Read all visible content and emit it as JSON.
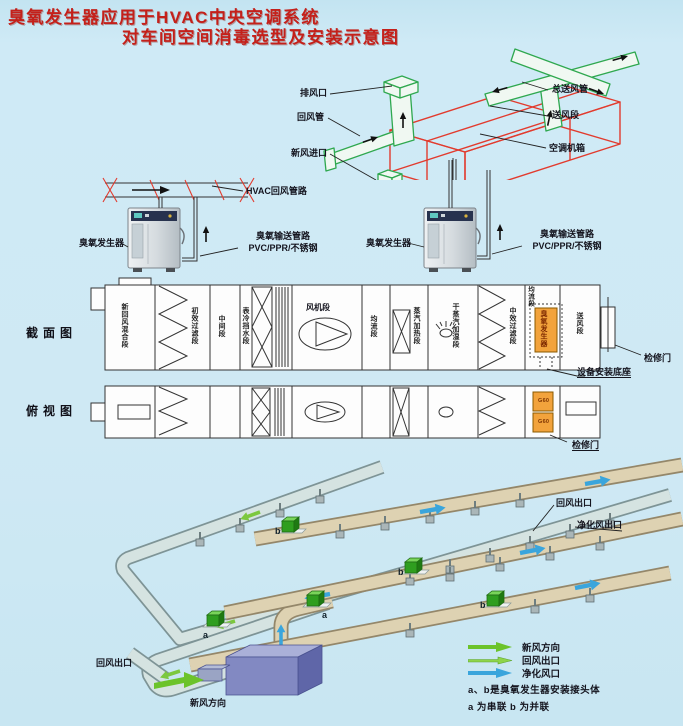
{
  "title": {
    "line1": "臭氧发生器应用于HVAC中央空调系统",
    "line2": "对车间空间消毒选型及安装示意图"
  },
  "top_diagram": {
    "exhaust_outlet": "排风口",
    "return_duct": "回风管",
    "fresh_air_inlet": "新风进口",
    "main_supply_duct": "总送风管",
    "supply_section": "送风段",
    "ahu_cabinet": "空调机箱"
  },
  "ozone_units": {
    "hvac_return_line": "HVAC回风管路",
    "left": {
      "name": "臭氧发生器",
      "pipe_line1": "臭氧输送管路",
      "pipe_line2": "PVC/PPR/不锈钢"
    },
    "right": {
      "name": "臭氧发生器",
      "pipe_line1": "臭氧输送管路",
      "pipe_line2": "PVC/PPR/不锈钢"
    }
  },
  "section_view": {
    "title": "截面图",
    "sections": [
      "新回风混合段",
      "初效过滤段",
      "中间段",
      "表冷挡水段",
      "风机段",
      "均流段",
      "蒸汽加热段",
      "干蒸汽加湿段",
      "中效过滤段",
      "均流段",
      "送风段"
    ],
    "ozone_box_label": "臭氧发生器",
    "access_door": "检修门",
    "mounting_base": "设备安装底座"
  },
  "plan_view": {
    "title": "俯视图",
    "unit_tag": "G60",
    "access_door": "检修门"
  },
  "network": {
    "return_outlet_left": "回风出口",
    "return_outlet_right": "回风出口",
    "purified_outlet": "净化风出口",
    "fresh_air_direction": "新风方向",
    "marker_a": "a",
    "marker_b": "b"
  },
  "legend": {
    "fresh_label": "新风方向",
    "return_label": "回风出口",
    "purified_label": "净化风口",
    "note1": "a、b是臭氧发生器安装接头体",
    "note2": "a 为串联 b 为并联"
  },
  "colors": {
    "title_red": "#c4201a",
    "wireframe_red": "#e23b2e",
    "duct_green": "#2fa84f",
    "highlight_orange": "#f2a33c",
    "supply_duct_beige": "#ded2b2",
    "return_duct_gray": "#d5e3e1",
    "ahu_purple": "#8289c2",
    "arrow_green": "#6cc32a",
    "arrow_blue": "#3aa5dc"
  }
}
